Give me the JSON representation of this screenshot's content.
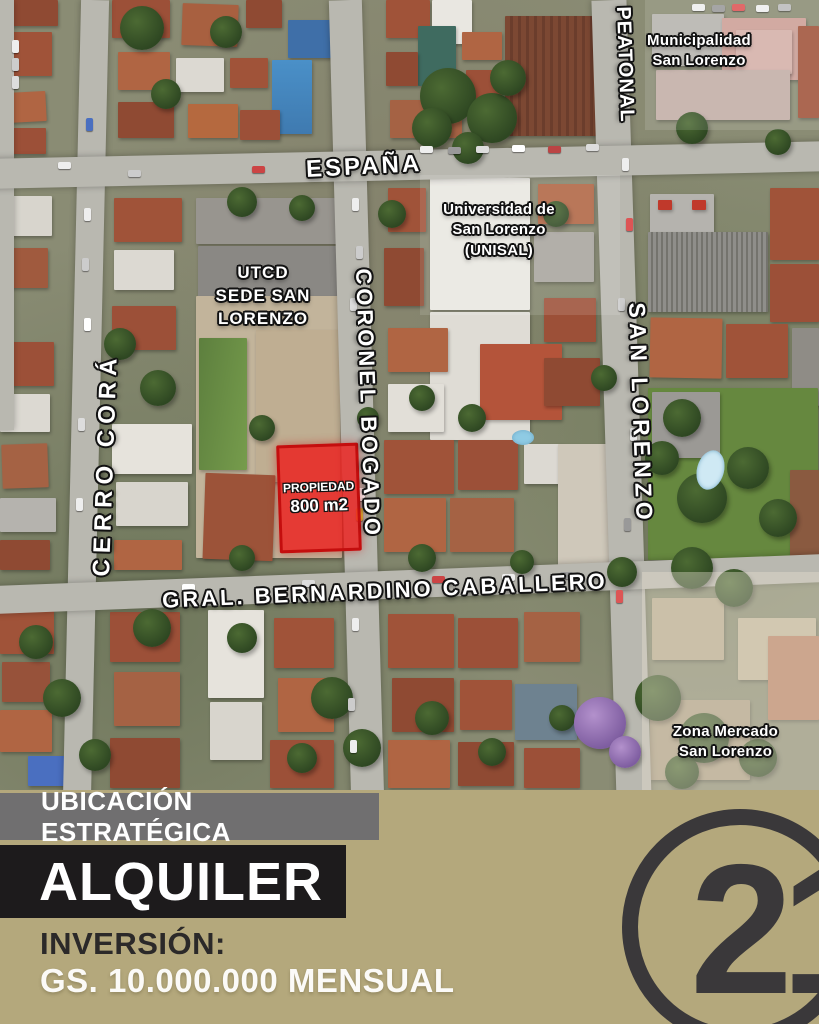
{
  "map": {
    "streets": {
      "espana": "ESPAÑA",
      "peatonal": "PEATONAL",
      "cerro_cora": "CERRO CORÁ",
      "coronel_bogado": "CORONEL BOGADO",
      "san_lorenzo": "SAN LORENZO",
      "bernardino": "GRAL. BERNARDINO CABALLERO"
    },
    "places": {
      "municipalidad": {
        "line1": "Municipalidad",
        "line2": "San Lorenzo"
      },
      "unisal": {
        "line1": "Universidad de",
        "line2": "San Lorenzo",
        "line3": "(UNISAL)"
      },
      "utcd": {
        "line1": "UTCD",
        "line2": "SEDE SAN",
        "line3": "LORENZO"
      },
      "zona_mercado": {
        "line1": "Zona Mercado",
        "line2": "San Lorenzo"
      }
    },
    "property": {
      "label": "PROPIEDAD",
      "area": "800 m2",
      "highlight_color": "#ed1c1a"
    }
  },
  "banner": {
    "tagline": "UBICACIÓN ESTRATÉGICA",
    "offer": "ALQUILER",
    "investment_label": "INVERSIÓN:",
    "investment_value": "GS. 10.000.000 MENSUAL",
    "background_color": "#b4a87c",
    "tagline_bg": "#706f70",
    "offer_bg": "#1d1b1c"
  },
  "logo": {
    "number": "21",
    "color": "#3a383a"
  }
}
